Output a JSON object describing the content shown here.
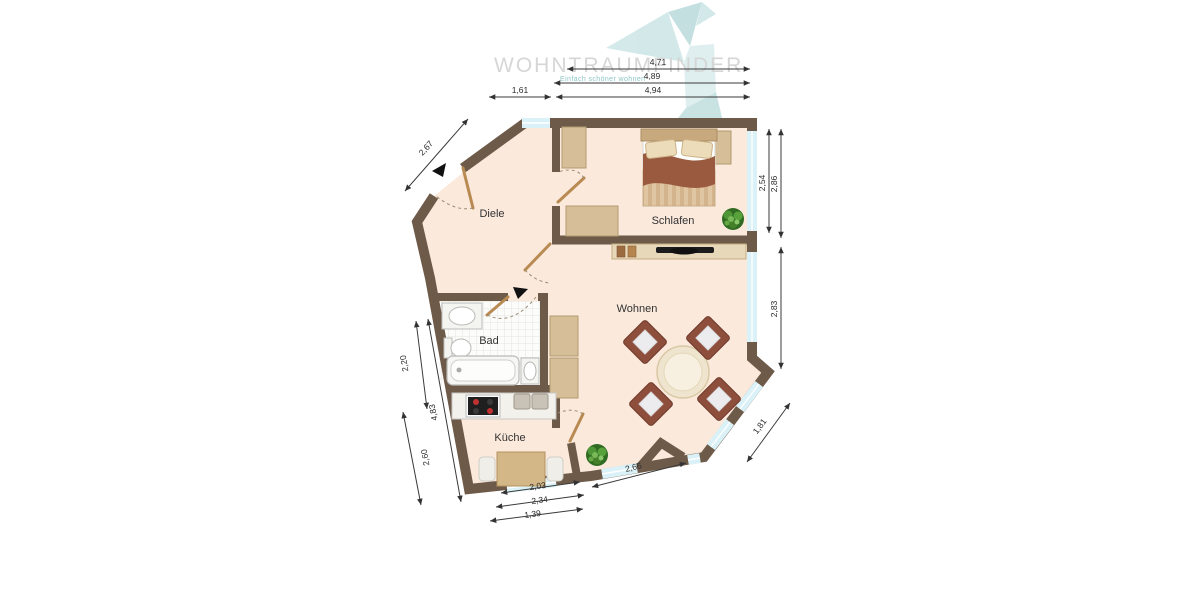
{
  "watermark": {
    "brand": "WOHNTRAUMFINDER",
    "tagline": "Einfach schöner wohnen",
    "logo_icon": "origami-crane"
  },
  "rooms": {
    "diele": "Diele",
    "schlafen": "Schlafen",
    "wohnen": "Wohnen",
    "bad": "Bad",
    "kueche": "Küche"
  },
  "dimensions": {
    "d471": "4,71",
    "d489": "4,89",
    "d161": "1,61",
    "d494": "4,94",
    "d267": "2,67",
    "d254": "2,54",
    "d286": "2,86",
    "d283": "2,83",
    "d181": "1,81",
    "d220": "2,20",
    "d483": "4,83",
    "d260": "2,60",
    "d203": "2,03",
    "d234": "2,34",
    "d139": "1,39",
    "d266": "2,66"
  },
  "icons": {
    "logo": "origami-crane-icon",
    "entrance_marker": "direction-triangle-icon",
    "bath_marker": "direction-triangle-icon"
  },
  "colors": {
    "wall": "#6e5a49",
    "floor": "#fbe9dc",
    "window": "#d9f1f7",
    "tile": "#fcfcfb",
    "dimension": "#333333",
    "logo_teal": "#cde5e5",
    "watermark_gray": "#d6d6d6",
    "furniture_tan": "#d6bf98",
    "chair_brown": "#8d4e3c",
    "bed_blanket": "#9a5a40",
    "plant_green": "#4e9636",
    "marker_black": "#111111"
  }
}
